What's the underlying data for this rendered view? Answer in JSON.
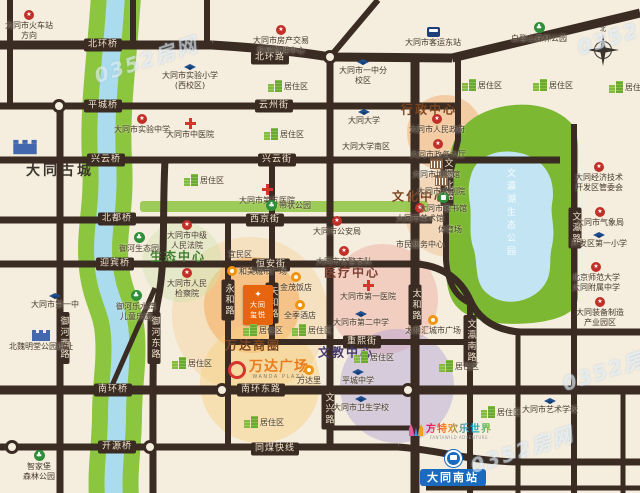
{
  "watermark": "0352房网",
  "compass_label": "北",
  "colors": {
    "background": "#f5edde",
    "road": "#3a2b23",
    "river_bank_green": "#8cc63f",
    "river_water": "#aadced",
    "park_green": "#7cb832",
    "lake_blue": "#c3e5f3",
    "project_orange": "#e8650f",
    "station_blue": "#1a6abf",
    "wanda_orange": "#e87c1e"
  },
  "landmarks": {
    "ancient_city": {
      "label": "大同古城"
    },
    "wanda": {
      "name": "万达广场",
      "latin": "WANDA PLAZA",
      "district_label": "万达商圈"
    },
    "project": {
      "lines": [
        "大同",
        "玺悦"
      ],
      "emblem": "✦"
    },
    "fantawild": {
      "name": "方特欢乐世界",
      "latin": "FANTAWILD ADVENTURE"
    },
    "south_station": {
      "label": "大同南站"
    },
    "lake": {
      "label": "文瀛湖生态公园"
    }
  },
  "zone_titles": [
    {
      "label": "行政中心",
      "x": 429,
      "y": 109,
      "color": "#7a4520"
    },
    {
      "label": "文化中心",
      "x": 420,
      "y": 196,
      "color": "#7a4520"
    },
    {
      "label": "医疗中心",
      "x": 352,
      "y": 272,
      "color": "#7c3f33"
    },
    {
      "label": "文教中心",
      "x": 346,
      "y": 352,
      "color": "#463a6e"
    },
    {
      "label": "生态中心",
      "x": 178,
      "y": 256,
      "color": "#3e7d2e"
    },
    {
      "label": "万达商圈",
      "x": 253,
      "y": 345,
      "color": "#7a4520"
    }
  ],
  "zones": [
    {
      "name": "xingzheng-center",
      "x": 445,
      "y": 133,
      "r": 38,
      "color": "rgba(243,176,116,0.55)"
    },
    {
      "name": "wenhua-center",
      "x": 449,
      "y": 213,
      "r": 44,
      "color": "rgba(242,200,160,0.6)"
    },
    {
      "name": "yiliao-center",
      "x": 383,
      "y": 299,
      "r": 55,
      "color": "rgba(240,176,162,0.5)"
    },
    {
      "name": "wenjiao-center",
      "x": 397,
      "y": 386,
      "r": 57,
      "color": "rgba(176,162,216,0.45)"
    },
    {
      "name": "project-glow",
      "x": 252,
      "y": 305,
      "r": 48,
      "color": "rgba(245,158,66,0.5)"
    },
    {
      "name": "project-glow-outer",
      "x": 250,
      "y": 315,
      "r": 78,
      "color": "rgba(246,190,110,0.28)"
    },
    {
      "name": "wanda-circle",
      "x": 260,
      "y": 383,
      "r": 60,
      "color": "rgba(247,210,130,0.5)"
    },
    {
      "name": "shengtai-center",
      "x": 182,
      "y": 262,
      "r": 40,
      "color": "rgba(205,228,170,0.4)"
    }
  ],
  "road_labels": [
    {
      "label": "北环桥",
      "x": 103,
      "y": 45
    },
    {
      "label": "北环路",
      "x": 270,
      "y": 58
    },
    {
      "label": "平城桥",
      "x": 103,
      "y": 106
    },
    {
      "label": "云州街",
      "x": 274,
      "y": 106
    },
    {
      "label": "兴云桥",
      "x": 106,
      "y": 160
    },
    {
      "label": "兴云街",
      "x": 277,
      "y": 160
    },
    {
      "label": "北都桥",
      "x": 117,
      "y": 219
    },
    {
      "label": "西京街",
      "x": 265,
      "y": 220
    },
    {
      "label": "迎宾桥",
      "x": 115,
      "y": 264
    },
    {
      "label": "恒安街",
      "x": 271,
      "y": 265
    },
    {
      "label": "重熙街",
      "x": 362,
      "y": 342
    },
    {
      "label": "南环桥",
      "x": 113,
      "y": 390
    },
    {
      "label": "南环东路",
      "x": 261,
      "y": 390
    },
    {
      "label": "开源桥",
      "x": 117,
      "y": 447
    },
    {
      "label": "同煤快线",
      "x": 275,
      "y": 449
    },
    {
      "label": "御河西路",
      "x": 63,
      "y": 338,
      "v": true
    },
    {
      "label": "御河东路",
      "x": 154,
      "y": 338,
      "v": true
    },
    {
      "label": "永和路",
      "x": 228,
      "y": 300,
      "v": true
    },
    {
      "label": "天和路",
      "x": 272,
      "y": 303,
      "v": true
    },
    {
      "label": "文兴路",
      "x": 328,
      "y": 409,
      "v": true
    },
    {
      "label": "太和路",
      "x": 415,
      "y": 305,
      "v": true
    },
    {
      "label": "文瀛北路",
      "x": 447,
      "y": 180,
      "v": true
    },
    {
      "label": "文瀛南路",
      "x": 470,
      "y": 341,
      "v": true
    },
    {
      "label": "文瀛路",
      "x": 575,
      "y": 228,
      "v": true
    }
  ],
  "pois": [
    {
      "icon": "red-badge",
      "x": 29,
      "y": 10,
      "lines": [
        "大同市火车站",
        "方向"
      ]
    },
    {
      "icon": "red-badge",
      "x": 281,
      "y": 25,
      "lines": [
        "大同市房产交易",
        "权属管理中心"
      ]
    },
    {
      "icon": "red-badge",
      "x": 437,
      "y": 114,
      "lines": [
        "大同市人民政府"
      ]
    },
    {
      "icon": "red-badge",
      "x": 438,
      "y": 139,
      "lines": [
        "大同市政务大厅"
      ]
    },
    {
      "icon": "red-badge",
      "x": 187,
      "y": 220,
      "lines": [
        "大同市中级",
        "人民法院"
      ]
    },
    {
      "icon": "red-badge",
      "x": 187,
      "y": 268,
      "lines": [
        "大同市人民",
        "检察院"
      ]
    },
    {
      "icon": "red-badge",
      "x": 337,
      "y": 216,
      "lines": [
        "大同市公安局"
      ]
    },
    {
      "icon": "red-badge",
      "x": 344,
      "y": 246,
      "lines": [
        "大同市交警支队"
      ]
    },
    {
      "icon": "red-badge",
      "x": 599,
      "y": 162,
      "lines": [
        "大同经济技术",
        "开发区管委会"
      ]
    },
    {
      "icon": "red-badge",
      "x": 600,
      "y": 207,
      "lines": [
        "大同市气象局"
      ]
    },
    {
      "icon": "red-badge",
      "x": 596,
      "y": 262,
      "lines": [
        "北京师范大学",
        "大同附属中学"
      ]
    },
    {
      "icon": "red-badge",
      "x": 600,
      "y": 297,
      "lines": [
        "大同装备制造",
        "产业园区"
      ]
    },
    {
      "icon": "red-badge",
      "x": 142,
      "y": 114,
      "lines": [
        "大同市实验中学"
      ]
    },
    {
      "icon": "red-badge",
      "x": 420,
      "y": 203,
      "lines": [
        "大同市美术馆"
      ]
    },
    {
      "icon": "red-cross",
      "x": 190,
      "y": 118,
      "lines": [
        "大同市中医院"
      ]
    },
    {
      "icon": "red-cross",
      "x": 267,
      "y": 184,
      "lines": [
        "大同市第五医院"
      ]
    },
    {
      "icon": "red-cross",
      "x": 368,
      "y": 280,
      "lines": [
        "大同市第一医院"
      ]
    },
    {
      "icon": "grad-cap",
      "x": 190,
      "y": 64,
      "lines": [
        "大同市实验小学",
        "(西校区)"
      ]
    },
    {
      "icon": "grad-cap",
      "x": 363,
      "y": 59,
      "lines": [
        "大同市一中分",
        "校区"
      ]
    },
    {
      "icon": "grad-cap",
      "x": 364,
      "y": 109,
      "lines": [
        "大同大学"
      ]
    },
    {
      "icon": "none",
      "x": 366,
      "y": 142,
      "lines": [
        "大同大学南区"
      ]
    },
    {
      "icon": "grad-cap",
      "x": 361,
      "y": 311,
      "lines": [
        "大同市第二中学"
      ]
    },
    {
      "icon": "grad-cap",
      "x": 358,
      "y": 369,
      "lines": [
        "平城中学"
      ]
    },
    {
      "icon": "grad-cap",
      "x": 361,
      "y": 396,
      "lines": [
        "大同市卫生学校"
      ]
    },
    {
      "icon": "grad-cap",
      "x": 550,
      "y": 398,
      "lines": [
        "大同市艺术学校"
      ]
    },
    {
      "icon": "grad-cap",
      "x": 599,
      "y": 232,
      "lines": [
        "开发区第一小学"
      ]
    },
    {
      "icon": "grad-cap",
      "x": 55,
      "y": 293,
      "lines": [
        "大同市第一中"
      ]
    },
    {
      "icon": "buildings",
      "x": 268,
      "y": 80,
      "row": true,
      "lines": [
        "居住区"
      ]
    },
    {
      "icon": "buildings",
      "x": 264,
      "y": 128,
      "row": true,
      "lines": [
        "居住区"
      ]
    },
    {
      "icon": "buildings",
      "x": 184,
      "y": 174,
      "row": true,
      "lines": [
        "居住区"
      ]
    },
    {
      "icon": "buildings",
      "x": 462,
      "y": 79,
      "row": true,
      "lines": [
        "居住区"
      ]
    },
    {
      "icon": "buildings",
      "x": 533,
      "y": 79,
      "row": true,
      "lines": [
        "居住区"
      ]
    },
    {
      "icon": "buildings",
      "x": 609,
      "y": 81,
      "row": true,
      "lines": [
        "居住区"
      ]
    },
    {
      "icon": "buildings",
      "x": 172,
      "y": 357,
      "row": true,
      "lines": [
        "居住区"
      ]
    },
    {
      "icon": "buildings",
      "x": 243,
      "y": 324,
      "row": true,
      "lines": [
        "居住区"
      ]
    },
    {
      "icon": "buildings",
      "x": 292,
      "y": 324,
      "row": true,
      "lines": [
        "居住区"
      ]
    },
    {
      "icon": "buildings",
      "x": 439,
      "y": 360,
      "row": true,
      "lines": [
        "居住区"
      ]
    },
    {
      "icon": "buildings",
      "x": 481,
      "y": 406,
      "row": true,
      "lines": [
        "居住区"
      ]
    },
    {
      "icon": "buildings",
      "x": 244,
      "y": 416,
      "row": true,
      "lines": [
        "居住区"
      ]
    },
    {
      "icon": "buildings",
      "x": 354,
      "y": 351,
      "row": true,
      "lines": [
        "居住区"
      ]
    },
    {
      "icon": "tree",
      "x": 539,
      "y": 22,
      "lines": [
        "白登山森林公园"
      ]
    },
    {
      "icon": "tree",
      "x": 266,
      "y": 200,
      "row": true,
      "lines": [
        "带状公园"
      ]
    },
    {
      "icon": "tree",
      "x": 139,
      "y": 232,
      "lines": [
        "御河生态园"
      ]
    },
    {
      "icon": "tree",
      "x": 136,
      "y": 290,
      "lines": [
        "御河乐水湾",
        "儿童乐园"
      ]
    },
    {
      "icon": "tree",
      "x": 39,
      "y": 450,
      "lines": [
        "智家堡",
        "森林公园"
      ]
    },
    {
      "icon": "green-dot",
      "x": 443,
      "y": 192,
      "lines": [
        "大同市图书馆"
      ]
    },
    {
      "icon": "orange",
      "x": 296,
      "y": 272,
      "lines": [
        "金茂饭店"
      ]
    },
    {
      "icon": "orange",
      "x": 300,
      "y": 300,
      "lines": [
        "全季酒店"
      ]
    },
    {
      "icon": "orange",
      "x": 433,
      "y": 315,
      "lines": [
        "太和汇城市广场"
      ]
    },
    {
      "icon": "orange",
      "x": 227,
      "y": 266,
      "row": true,
      "lines": [
        "和美城市广场"
      ]
    },
    {
      "icon": "orange",
      "x": 309,
      "y": 365,
      "lines": [
        "万达里"
      ]
    },
    {
      "icon": "none",
      "x": 240,
      "y": 250,
      "lines": [
        "宜民区"
      ]
    },
    {
      "icon": "none",
      "x": 450,
      "y": 225,
      "lines": [
        "体育场"
      ]
    },
    {
      "icon": "none",
      "x": 420,
      "y": 240,
      "lines": [
        "市民服务中心"
      ]
    },
    {
      "icon": "columns",
      "x": 441,
      "y": 175,
      "lines": [
        "大同市大剧院"
      ]
    },
    {
      "icon": "columns",
      "x": 436,
      "y": 158,
      "lines": [
        "大同市博物馆"
      ]
    },
    {
      "icon": "bus",
      "x": 433,
      "y": 27,
      "lines": [
        "大同市客运东站"
      ]
    },
    {
      "icon": "wall",
      "x": 41,
      "y": 330,
      "lines": [
        "北魏明堂公园遗址"
      ]
    }
  ]
}
